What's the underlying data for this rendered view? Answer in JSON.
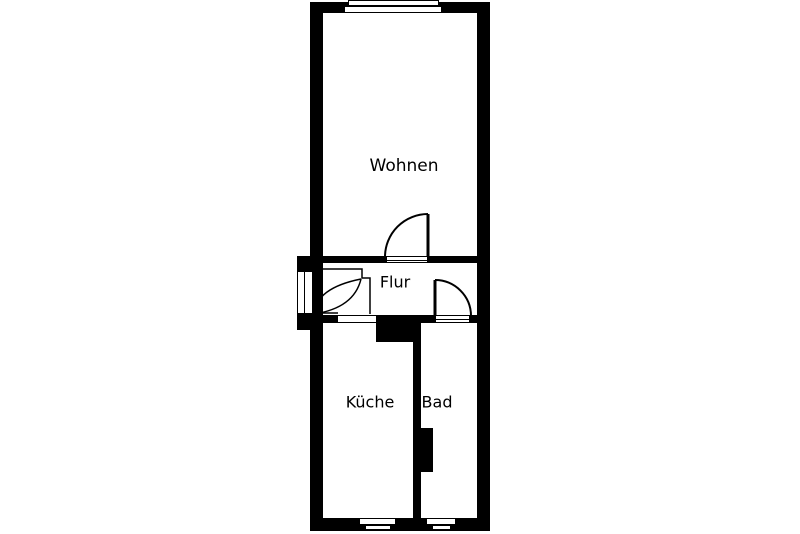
{
  "diagram": {
    "type": "apartment floor plan",
    "colors": {
      "wall": "#000000",
      "floor": "#ffffff"
    },
    "rooms": {
      "wohnen": {
        "label": "Wohnen"
      },
      "flur": {
        "label": "Flur"
      },
      "kueche": {
        "label": "Küche"
      },
      "bad": {
        "label": "Bad"
      }
    }
  }
}
